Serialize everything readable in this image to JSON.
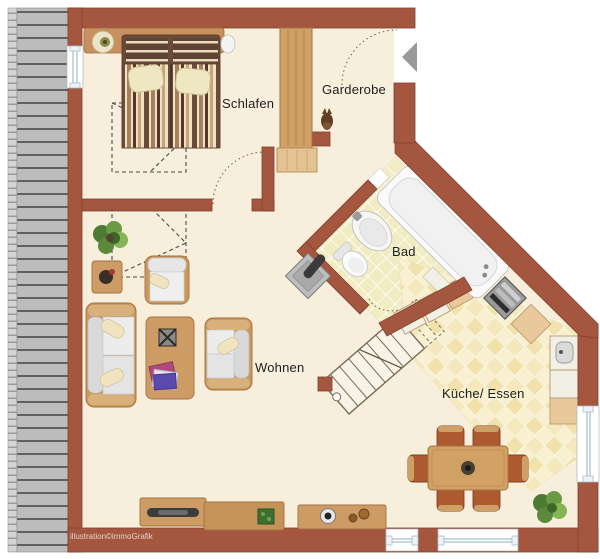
{
  "plan": {
    "type": "apartment-floor-plan",
    "rooms": [
      {
        "id": "schlafen",
        "label": "Schlafen"
      },
      {
        "id": "garderobe",
        "label": "Garderobe"
      },
      {
        "id": "bad",
        "label": "Bad"
      },
      {
        "id": "wohnen",
        "label": "Wohnen"
      },
      {
        "id": "kueche_essen",
        "label": "Küche/ Essen"
      }
    ],
    "watermark": "illustration©immoGrafik",
    "icons": {
      "entry_arrow": "entry-direction-arrow",
      "stove": "kamin-stove",
      "cat": "cat-figure"
    },
    "colors": {
      "wall": "#a5563e",
      "wall_outline": "#7e4130",
      "floor": "#f7efdb",
      "bath_tile": "#f2ecc3",
      "kitchen_tile_light": "#f8f0d0",
      "kitchen_tile_dark": "#f1e2ac",
      "balcony_plank": "#bcbcbc",
      "wood": "#cd9c64",
      "arrow_gray": "#9a9a9a"
    }
  }
}
